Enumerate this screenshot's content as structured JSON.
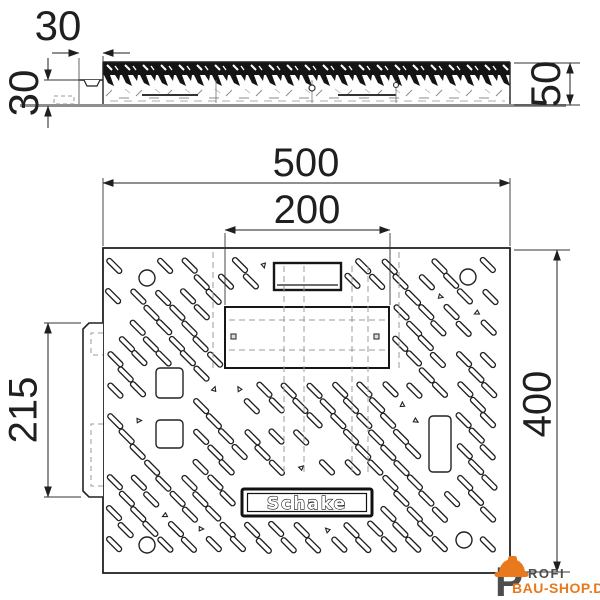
{
  "page": {
    "background": "#ffffff"
  },
  "drawing": {
    "colors": {
      "line": "#222222",
      "dimension": "#1f1f1f",
      "hidden_line": "#9b9b9b",
      "ground_line": "#8f8f8f",
      "watermark_orange": "#e8791d",
      "watermark_dark": "#4d4d4d"
    },
    "side_view": {
      "lip_width_label": "30",
      "height_left_label": "30",
      "height_right_label": "50"
    },
    "plan_view": {
      "width_label": "500",
      "opening_label": "200",
      "left_recess_label": "215",
      "depth_label": "400",
      "brand_plate_label": "Schake"
    },
    "watermark": {
      "p": "P",
      "rofi": "ROFI",
      "line2": "BAU-SHOP.DE"
    },
    "pattern": {
      "slot_angle_deg": 45,
      "slot_length": 19,
      "slot_width": 5,
      "grid": {
        "x0": 114,
        "y0": 266,
        "dx": 25,
        "dy": 15.5,
        "rows": 20,
        "cols": 16,
        "row_offset": 12.5
      },
      "bounds": {
        "x1": 110,
        "y1": 258,
        "x2": 497,
        "y2": 557
      },
      "skip_ratio": 0.13,
      "speck_ratio": 0.06,
      "seed": 42,
      "exclusion_rects": [
        [
          266,
          246,
          350,
          298
        ],
        [
          216,
          296,
          398,
          378
        ],
        [
          232,
          480,
          382,
          526
        ],
        [
          146,
          360,
          196,
          454
        ],
        [
          418,
          404,
          462,
          484
        ]
      ],
      "exclusion_circles": [
        [
          147,
          278
        ],
        [
          468,
          277
        ],
        [
          147,
          545
        ],
        [
          464,
          540
        ]
      ],
      "exclusion_radius": 16
    }
  }
}
